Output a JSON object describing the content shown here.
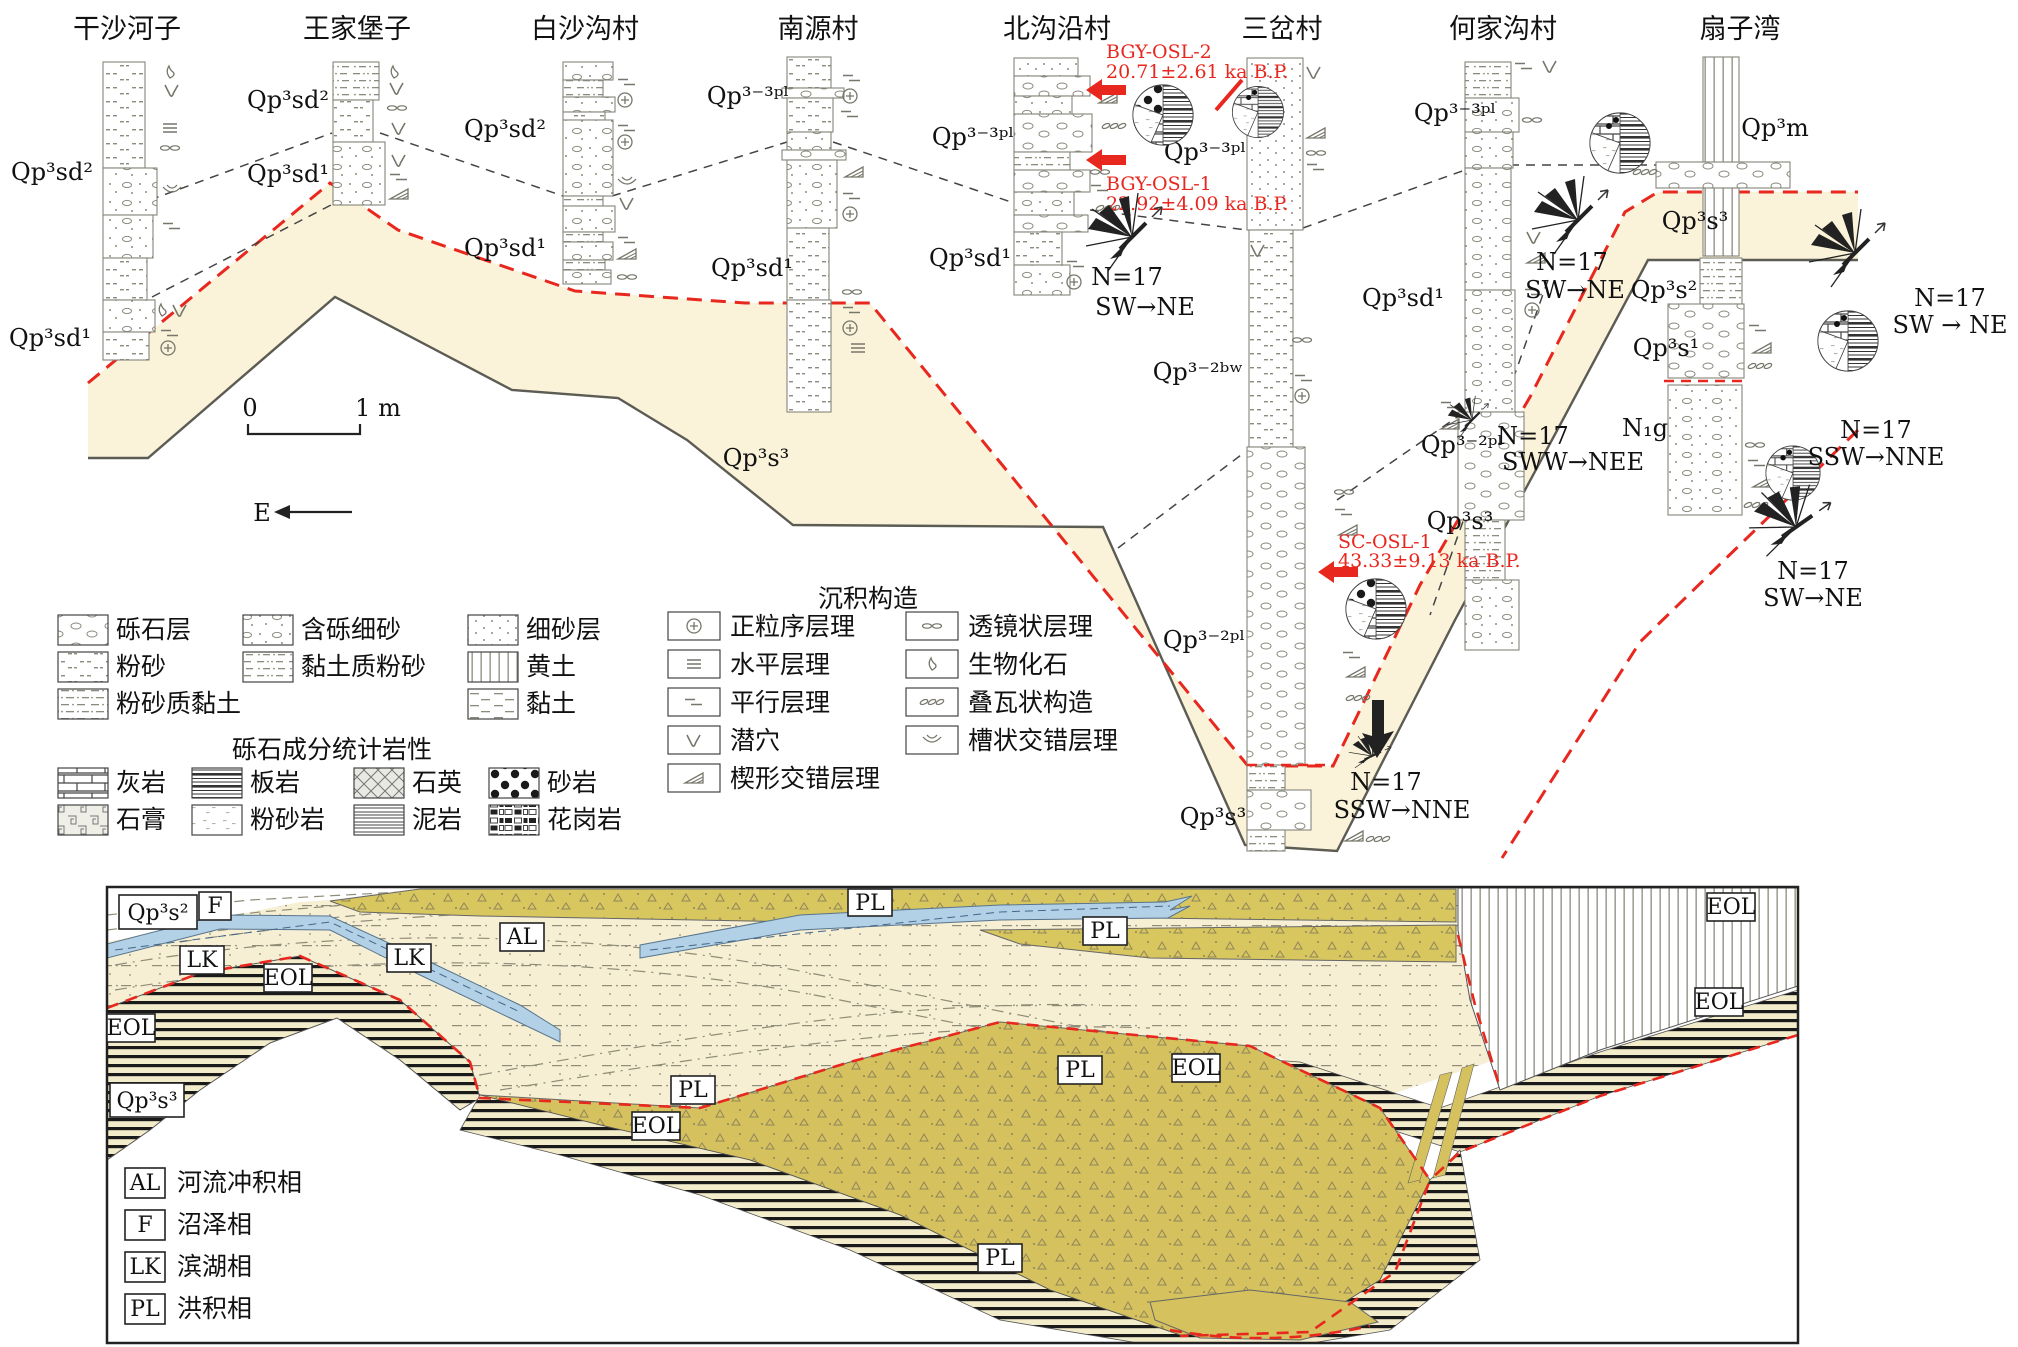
{
  "figure": {
    "sites": [
      "干沙河子",
      "王家堡子",
      "白沙沟村",
      "南源村",
      "北沟沿村",
      "三岔村",
      "何家沟村",
      "扇子湾"
    ],
    "units": {
      "qp3sd2": "Qp³sd²",
      "qp3sd1": "Qp³sd¹",
      "qp3_3pl": "Qp³⁻³ᵖˡ",
      "qp3_2bw": "Qp³⁻²ᵇʷ",
      "qp3_2pl": "Qp³⁻²ᵖˡ",
      "qp3s3": "Qp³s³",
      "qp3s2": "Qp³s²",
      "qp3s1": "Qp³s¹",
      "qp3m": "Qp³m",
      "n1g": "N₁g"
    },
    "osl": {
      "bgy_osl_2": "BGY-OSL-2",
      "bgy_osl_2_age": "20.71±2.61 ka B.P.",
      "bgy_osl_1": "BGY-OSL-1",
      "bgy_osl_1_age": "22.92±4.09 ka B.P.",
      "sc_osl_1": "SC-OSL-1",
      "sc_osl_1_age": "43.33±9.13 ka B.P."
    },
    "paleocurrent": {
      "n17": "N=17",
      "sw_ne": "SW→NE",
      "sw_ne_spaced": "SW → NE",
      "sww_nee": "SWW→NEE",
      "ssw_nne": "SSW→NNE"
    },
    "scalebar": {
      "zero": "0",
      "one_meter": "1 m",
      "east": "E"
    }
  },
  "legend": {
    "lithology": [
      "砾石层",
      "含砾细砂",
      "细砂层",
      "粉砂",
      "黏土质粉砂",
      "黄土",
      "粉砂质黏土",
      "黏土"
    ],
    "sed_structures_title": "沉积构造",
    "sed_structures": [
      "正粒序层理",
      "水平层理",
      "平行层理",
      "潜穴",
      "楔形交错层理",
      "透镜状层理",
      "生物化石",
      "叠瓦状构造",
      "槽状交错层理"
    ],
    "gravel_title": "砾石成分统计岩性",
    "gravel_lithology": [
      "灰岩",
      "板岩",
      "石英",
      "砂岩",
      "石膏",
      "粉砂岩",
      "泥岩",
      "花岗岩"
    ]
  },
  "section": {
    "labels": {
      "pl": "PL",
      "eol": "EOL",
      "lk": "LK",
      "al": "AL",
      "f": "F"
    },
    "facies": [
      {
        "code": "AL",
        "name": "河流冲积相"
      },
      {
        "code": "F",
        "name": "沼泽相"
      },
      {
        "code": "LK",
        "name": "滨湖相"
      },
      {
        "code": "PL",
        "name": "洪积相"
      }
    ]
  },
  "colors": {
    "channel_fill": "#FAF3D9",
    "unconformity_red": "#E8271E",
    "lake_blue": "#B3D1E6",
    "proluvial_olive": "#D8C75F",
    "proluvial_cream": "#F6EFD4",
    "eol_background": "#F3ECCB"
  }
}
